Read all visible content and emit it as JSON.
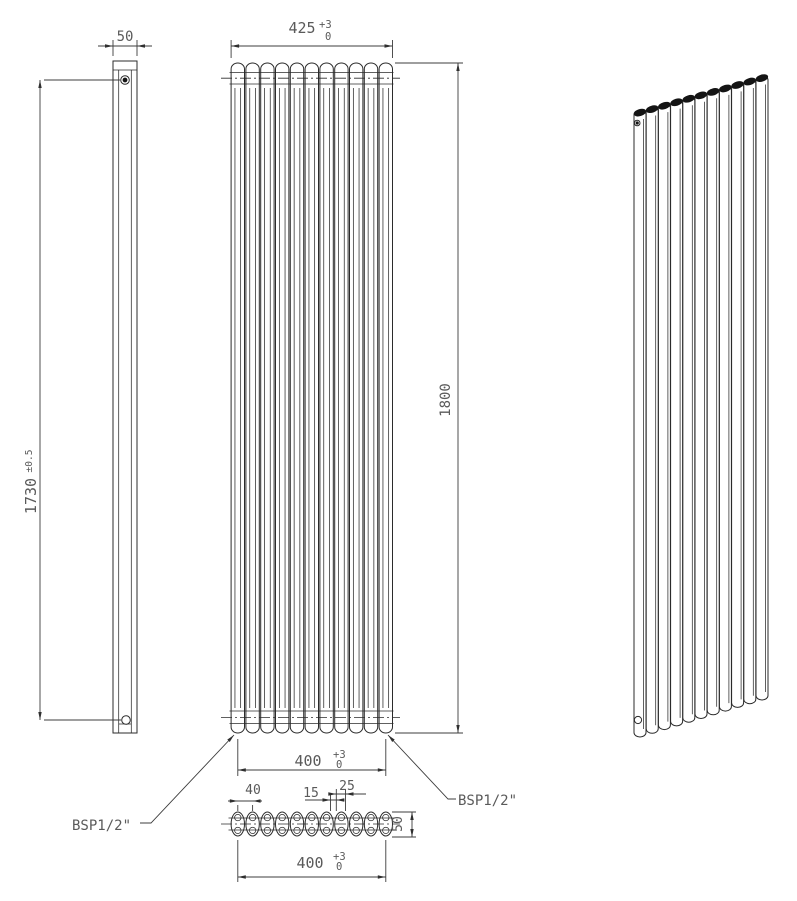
{
  "drawing": {
    "type": "technical-drawing",
    "subject": "vertical oval-tube radiator, three orthographic views plus isometric view",
    "tube_count": 11,
    "colors": {
      "line": "#2b2b2b",
      "text": "#5a5a5a",
      "background": "#ffffff"
    },
    "labels": {
      "side_width": "50",
      "overall_width": "425",
      "tol_plus": "+3",
      "tol_zero": "0",
      "centers_height": "1730",
      "centers_height_tol": "±0.5",
      "overall_height": "1800",
      "tube_span": "400",
      "tube_pitch": "40",
      "tube_gap": "15",
      "tube_width": "25",
      "tube_depth": "50",
      "section_span": "400",
      "bsp_left": "BSP1/2\"",
      "bsp_right": "BSP1/2\""
    }
  }
}
